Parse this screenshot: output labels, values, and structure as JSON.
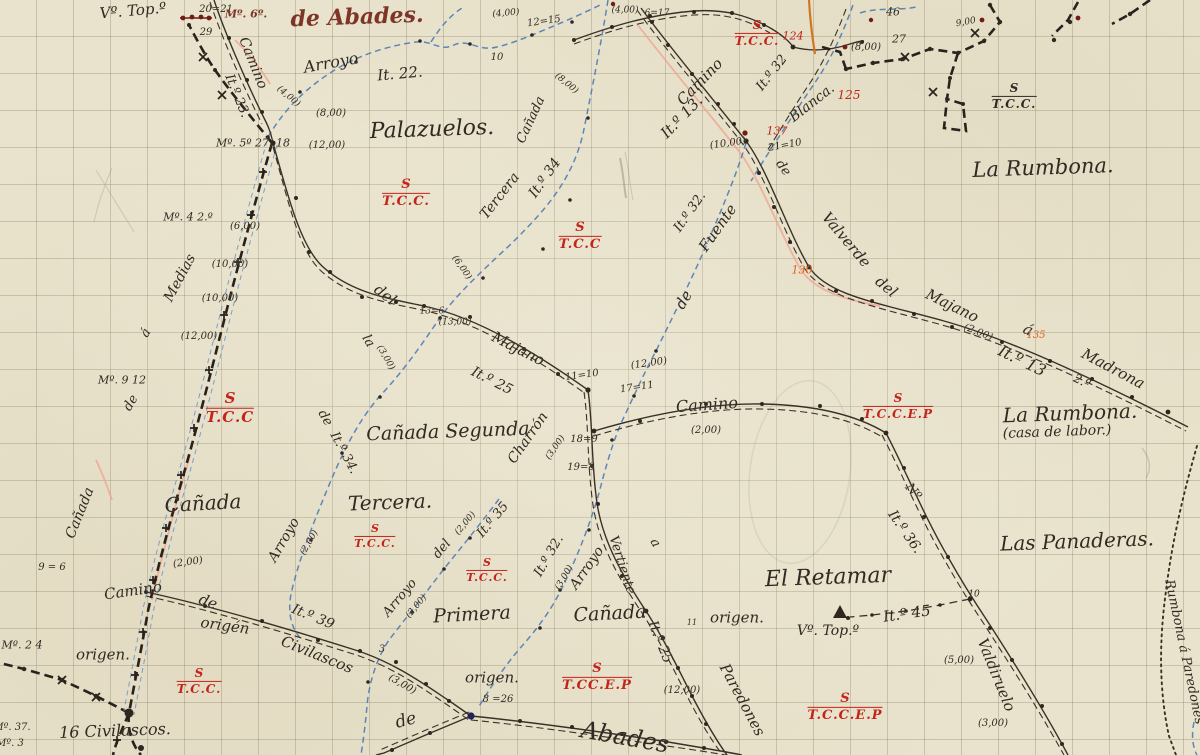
{
  "map": {
    "description": "Hand-drawn Spanish cadastral survey sketch on gridded paper",
    "accent_colors": {
      "ink": "#312a22",
      "stream_blue": "#4e7db6",
      "red": "#c4231a",
      "orange": "#dd6320",
      "brown_script": "#7c3527",
      "pink_trace": "#f0a08d",
      "orange_trace": "#d4741c"
    },
    "labels": [
      {
        "t": "Vº. Top.º",
        "x": 133,
        "y": 11,
        "r": -5,
        "s": 15
      },
      {
        "t": "20=21",
        "x": 216,
        "y": 10,
        "s": 10
      },
      {
        "t": "29",
        "x": 206,
        "y": 33,
        "s": 10
      },
      {
        "t": "Mº. 6º.",
        "x": 246,
        "y": 14,
        "s": 11,
        "c": "brown"
      },
      {
        "t": "de Abades.",
        "x": 357,
        "y": 17,
        "r": -2,
        "s": 22,
        "c": "brown"
      },
      {
        "t": "Camino",
        "x": 253,
        "y": 63,
        "r": 68,
        "s": 14
      },
      {
        "t": "It.º 23.",
        "x": 237,
        "y": 96,
        "r": 68,
        "s": 13
      },
      {
        "t": "(4,00)",
        "x": 288,
        "y": 97,
        "r": 40,
        "s": 9
      },
      {
        "t": "Arroyo",
        "x": 331,
        "y": 63,
        "r": -10,
        "s": 16
      },
      {
        "t": "It. 22.",
        "x": 400,
        "y": 74,
        "r": -5,
        "s": 15
      },
      {
        "t": "(4,00)",
        "x": 506,
        "y": 14,
        "r": -5,
        "s": 9
      },
      {
        "t": "12=15",
        "x": 544,
        "y": 22,
        "r": -8,
        "s": 10
      },
      {
        "t": "10",
        "x": 497,
        "y": 58,
        "s": 10
      },
      {
        "t": "(8,00)",
        "x": 331,
        "y": 114,
        "s": 10
      },
      {
        "t": "Mº. 5º 27, 18",
        "x": 253,
        "y": 143,
        "s": 11
      },
      {
        "t": "(12,00)",
        "x": 327,
        "y": 146,
        "s": 10
      },
      {
        "t": "Palazuelos.",
        "x": 432,
        "y": 130,
        "r": -2,
        "s": 22
      },
      {
        "t": "Cañada",
        "x": 531,
        "y": 120,
        "r": -65,
        "s": 13
      },
      {
        "t": "(8,00)",
        "x": 566,
        "y": 84,
        "r": 40,
        "s": 9
      },
      {
        "t": "(4,00)",
        "x": 625,
        "y": 11,
        "s": 9
      },
      {
        "t": "6=17",
        "x": 657,
        "y": 14,
        "s": 9
      },
      {
        "t": "124",
        "x": 793,
        "y": 36,
        "s": 11,
        "c": "red"
      },
      {
        "t": "46",
        "x": 893,
        "y": 12,
        "s": 11
      },
      {
        "t": "27",
        "x": 899,
        "y": 39,
        "s": 11
      },
      {
        "t": "(8,00)",
        "x": 866,
        "y": 48,
        "s": 10
      },
      {
        "t": "9,00",
        "x": 966,
        "y": 23,
        "r": -10,
        "s": 9
      },
      {
        "t": "125",
        "x": 849,
        "y": 95,
        "s": 12,
        "c": "red"
      },
      {
        "t": "Blanca.",
        "x": 812,
        "y": 103,
        "r": -38,
        "s": 14
      },
      {
        "t": "It.º 32",
        "x": 772,
        "y": 73,
        "r": -52,
        "s": 13
      },
      {
        "t": "Camino",
        "x": 700,
        "y": 82,
        "r": -46,
        "s": 15
      },
      {
        "t": "It.º 13.",
        "x": 682,
        "y": 117,
        "r": -46,
        "s": 15
      },
      {
        "t": "137",
        "x": 777,
        "y": 131,
        "s": 11,
        "c": "red"
      },
      {
        "t": "21=10",
        "x": 785,
        "y": 146,
        "r": -10,
        "s": 10
      },
      {
        "t": "(10,00)",
        "x": 728,
        "y": 144,
        "r": -8,
        "s": 10
      },
      {
        "t": "La Rumbona.",
        "x": 1043,
        "y": 168,
        "r": -2,
        "s": 21
      },
      {
        "t": "de",
        "x": 783,
        "y": 168,
        "r": 55,
        "s": 13
      },
      {
        "t": "Valverde",
        "x": 846,
        "y": 240,
        "r": 50,
        "s": 15
      },
      {
        "t": "del",
        "x": 886,
        "y": 287,
        "r": 40,
        "s": 15
      },
      {
        "t": "Majano",
        "x": 952,
        "y": 306,
        "r": 26,
        "s": 15
      },
      {
        "t": "á",
        "x": 1028,
        "y": 330,
        "r": 26,
        "s": 15
      },
      {
        "t": "Madrona",
        "x": 1113,
        "y": 369,
        "r": 28,
        "s": 15
      },
      {
        "t": "(2,00)",
        "x": 978,
        "y": 333,
        "r": 22,
        "s": 10
      },
      {
        "t": "135",
        "x": 1036,
        "y": 336,
        "s": 10,
        "c": "orange"
      },
      {
        "t": "It.º 13",
        "x": 1022,
        "y": 361,
        "r": 26,
        "s": 16
      },
      {
        "t": "2.º",
        "x": 1082,
        "y": 381,
        "r": 26,
        "s": 12
      },
      {
        "t": "130",
        "x": 802,
        "y": 270,
        "s": 11,
        "c": "orange"
      },
      {
        "t": "It.º 32.",
        "x": 690,
        "y": 212,
        "r": -55,
        "s": 13
      },
      {
        "t": "Fuente",
        "x": 718,
        "y": 228,
        "r": -55,
        "s": 15
      },
      {
        "t": "de",
        "x": 684,
        "y": 300,
        "r": -60,
        "s": 15
      },
      {
        "t": "Mº. 4 2.º",
        "x": 188,
        "y": 217,
        "s": 11
      },
      {
        "t": "(6,00)",
        "x": 245,
        "y": 227,
        "s": 10
      },
      {
        "t": "(10,00)",
        "x": 230,
        "y": 265,
        "s": 10
      },
      {
        "t": "(10,00)",
        "x": 220,
        "y": 299,
        "s": 10
      },
      {
        "t": "(12,00)",
        "x": 199,
        "y": 337,
        "s": 10
      },
      {
        "t": "Medias",
        "x": 180,
        "y": 278,
        "r": -62,
        "s": 14
      },
      {
        "t": "á",
        "x": 146,
        "y": 333,
        "r": -60,
        "s": 13
      },
      {
        "t": "Mº. 9 12",
        "x": 122,
        "y": 380,
        "s": 11
      },
      {
        "t": "de",
        "x": 131,
        "y": 403,
        "r": -60,
        "s": 13
      },
      {
        "t": "Cañada",
        "x": 80,
        "y": 513,
        "r": -68,
        "s": 14
      },
      {
        "t": "Cañada",
        "x": 203,
        "y": 503,
        "r": -3,
        "s": 20
      },
      {
        "t": "9 = 6",
        "x": 52,
        "y": 568,
        "s": 10
      },
      {
        "t": "(2,00)",
        "x": 188,
        "y": 563,
        "r": -8,
        "s": 10
      },
      {
        "t": "Camino",
        "x": 133,
        "y": 591,
        "r": -8,
        "s": 15
      },
      {
        "t": "de",
        "x": 208,
        "y": 602,
        "r": 20,
        "s": 15
      },
      {
        "t": "origén",
        "x": 225,
        "y": 626,
        "r": 8,
        "s": 15
      },
      {
        "t": "Civilascos",
        "x": 317,
        "y": 655,
        "r": 22,
        "s": 15
      },
      {
        "t": "It.º 39",
        "x": 313,
        "y": 617,
        "r": 22,
        "s": 14
      },
      {
        "t": "3",
        "x": 382,
        "y": 650,
        "s": 10
      },
      {
        "t": "(3,00)",
        "x": 402,
        "y": 685,
        "r": 30,
        "s": 10
      },
      {
        "t": "Mº. 2 4",
        "x": 22,
        "y": 645,
        "s": 11
      },
      {
        "t": "origen.",
        "x": 103,
        "y": 655,
        "s": 15
      },
      {
        "t": "Mº. 37.",
        "x": 12,
        "y": 728,
        "s": 10
      },
      {
        "t": "Mº. 3",
        "x": 10,
        "y": 744,
        "s": 10
      },
      {
        "t": "16 Civilascos.",
        "x": 115,
        "y": 731,
        "r": -2,
        "s": 16
      },
      {
        "t": "Tercera",
        "x": 500,
        "y": 196,
        "r": -52,
        "s": 14
      },
      {
        "t": "It.º 34",
        "x": 545,
        "y": 178,
        "r": -55,
        "s": 14
      },
      {
        "t": "del",
        "x": 385,
        "y": 295,
        "r": 38,
        "s": 15
      },
      {
        "t": "(6,00)",
        "x": 461,
        "y": 268,
        "r": 55,
        "s": 9
      },
      {
        "t": "13=6",
        "x": 432,
        "y": 312,
        "s": 9
      },
      {
        "t": "(13,00)",
        "x": 455,
        "y": 323,
        "s": 9
      },
      {
        "t": "Majano",
        "x": 518,
        "y": 349,
        "r": 27,
        "s": 15
      },
      {
        "t": "It.º 25",
        "x": 492,
        "y": 381,
        "r": 27,
        "s": 14
      },
      {
        "t": "11=10",
        "x": 582,
        "y": 376,
        "r": -8,
        "s": 10
      },
      {
        "t": "17=11",
        "x": 637,
        "y": 388,
        "r": -8,
        "s": 10
      },
      {
        "t": "(12,00)",
        "x": 649,
        "y": 364,
        "r": -8,
        "s": 10
      },
      {
        "t": "18=9",
        "x": 584,
        "y": 440,
        "s": 10
      },
      {
        "t": "19=8",
        "x": 581,
        "y": 468,
        "s": 10
      },
      {
        "t": "Camino",
        "x": 707,
        "y": 405,
        "r": -4,
        "s": 16
      },
      {
        "t": "(2,00)",
        "x": 706,
        "y": 431,
        "s": 10
      },
      {
        "t": "la",
        "x": 368,
        "y": 341,
        "r": 60,
        "s": 13
      },
      {
        "t": "(3,00)",
        "x": 385,
        "y": 358,
        "r": 60,
        "s": 9
      },
      {
        "t": "de",
        "x": 325,
        "y": 418,
        "r": 60,
        "s": 13
      },
      {
        "t": "It.º 34.",
        "x": 344,
        "y": 453,
        "r": 62,
        "s": 13
      },
      {
        "t": "Cañada Segunda",
        "x": 448,
        "y": 432,
        "r": -2,
        "s": 19
      },
      {
        "t": "Charrón",
        "x": 528,
        "y": 438,
        "r": -55,
        "s": 14
      },
      {
        "t": "(3,00)",
        "x": 556,
        "y": 448,
        "r": -55,
        "s": 9
      },
      {
        "t": "Tercera.",
        "x": 390,
        "y": 502,
        "r": -2,
        "s": 20
      },
      {
        "t": "Arroyo",
        "x": 284,
        "y": 540,
        "r": -60,
        "s": 14
      },
      {
        "t": "(2,00)",
        "x": 310,
        "y": 543,
        "r": -60,
        "s": 9
      },
      {
        "t": "Arroyo",
        "x": 400,
        "y": 598,
        "r": -50,
        "s": 13
      },
      {
        "t": "(2,00)",
        "x": 417,
        "y": 607,
        "r": -50,
        "s": 9
      },
      {
        "t": "del",
        "x": 442,
        "y": 549,
        "r": -50,
        "s": 13
      },
      {
        "t": "(2,00)",
        "x": 466,
        "y": 524,
        "r": -50,
        "s": 9
      },
      {
        "t": "It.º 35",
        "x": 493,
        "y": 520,
        "r": -50,
        "s": 13
      },
      {
        "t": "It.º 32.",
        "x": 549,
        "y": 556,
        "r": -60,
        "s": 13
      },
      {
        "t": "(3,00)",
        "x": 565,
        "y": 578,
        "r": -60,
        "s": 9
      },
      {
        "t": "Arroyo",
        "x": 587,
        "y": 568,
        "r": -55,
        "s": 14
      },
      {
        "t": "Primera",
        "x": 472,
        "y": 615,
        "r": -3,
        "s": 19
      },
      {
        "t": "Cañada",
        "x": 610,
        "y": 614,
        "r": -3,
        "s": 19
      },
      {
        "t": "Vertiente",
        "x": 622,
        "y": 565,
        "r": 72,
        "s": 13
      },
      {
        "t": "a",
        "x": 655,
        "y": 543,
        "r": 60,
        "s": 13
      },
      {
        "t": "It.º 25",
        "x": 660,
        "y": 642,
        "r": 68,
        "s": 14
      },
      {
        "t": "origen.",
        "x": 737,
        "y": 618,
        "s": 15
      },
      {
        "t": "11",
        "x": 692,
        "y": 623,
        "s": 8
      },
      {
        "t": "(12,00)",
        "x": 682,
        "y": 691,
        "s": 10
      },
      {
        "t": "Paredones",
        "x": 742,
        "y": 700,
        "r": 62,
        "s": 15
      },
      {
        "t": "Abades",
        "x": 625,
        "y": 737,
        "r": 10,
        "s": 24
      },
      {
        "t": "de",
        "x": 406,
        "y": 721,
        "r": -15,
        "s": 17
      },
      {
        "t": "origen.",
        "x": 492,
        "y": 678,
        "s": 15
      },
      {
        "t": "8 =26",
        "x": 498,
        "y": 700,
        "s": 10
      },
      {
        "t": "El Retamar",
        "x": 828,
        "y": 578,
        "r": -2,
        "s": 22
      },
      {
        "t": "Vº. Top.º",
        "x": 828,
        "y": 631,
        "s": 14
      },
      {
        "t": "It.º 45",
        "x": 907,
        "y": 614,
        "r": -8,
        "s": 15
      },
      {
        "t": "10",
        "x": 974,
        "y": 595,
        "s": 9
      },
      {
        "t": "Valdiruelo",
        "x": 996,
        "y": 675,
        "r": 68,
        "s": 15
      },
      {
        "t": "(5,00)",
        "x": 959,
        "y": 661,
        "s": 10
      },
      {
        "t": "(3,00)",
        "x": 993,
        "y": 724,
        "s": 10
      },
      {
        "t": "Nº",
        "x": 913,
        "y": 492,
        "r": 50,
        "s": 13
      },
      {
        "t": "It.º 36.",
        "x": 905,
        "y": 532,
        "r": 55,
        "s": 14
      },
      {
        "t": "Las Panaderas.",
        "x": 1077,
        "y": 541,
        "r": -2,
        "s": 20
      },
      {
        "t": "La Rumbona.",
        "x": 1070,
        "y": 413,
        "r": -2,
        "s": 20
      },
      {
        "t": "(casa de labor.)",
        "x": 1057,
        "y": 432,
        "r": -2,
        "s": 14
      },
      {
        "t": "Rumbona á Paredones",
        "x": 1184,
        "y": 652,
        "r": 78,
        "s": 13
      }
    ],
    "fractions": [
      {
        "top": "S",
        "bottom": "T.C.C.",
        "x": 406,
        "y": 193,
        "s": 13,
        "c": "red"
      },
      {
        "top": "S",
        "bottom": "T.C.C",
        "x": 580,
        "y": 236,
        "s": 13,
        "c": "red"
      },
      {
        "top": "S",
        "bottom": "T.C.C.",
        "x": 757,
        "y": 33,
        "s": 12,
        "c": "red"
      },
      {
        "top": "S",
        "bottom": "T.C.C.",
        "x": 1014,
        "y": 96,
        "s": 12,
        "c": "ink"
      },
      {
        "top": "S",
        "bottom": "T.C.C",
        "x": 230,
        "y": 408,
        "s": 15,
        "c": "red"
      },
      {
        "top": "S",
        "bottom": "T.C.C.",
        "x": 375,
        "y": 536,
        "s": 11,
        "c": "red"
      },
      {
        "top": "S",
        "bottom": "T.C.C.",
        "x": 487,
        "y": 570,
        "s": 11,
        "c": "red"
      },
      {
        "top": "S",
        "bottom": "T.C.C.",
        "x": 199,
        "y": 681,
        "s": 12,
        "c": "red"
      },
      {
        "top": "S",
        "bottom": "T.CC.E.P",
        "x": 597,
        "y": 677,
        "s": 13,
        "c": "red"
      },
      {
        "top": "S",
        "bottom": "T.C.C.E.P",
        "x": 845,
        "y": 707,
        "s": 13,
        "c": "red"
      },
      {
        "top": "S",
        "bottom": "T.C.C.E.P",
        "x": 898,
        "y": 406,
        "s": 12,
        "c": "red"
      }
    ]
  }
}
